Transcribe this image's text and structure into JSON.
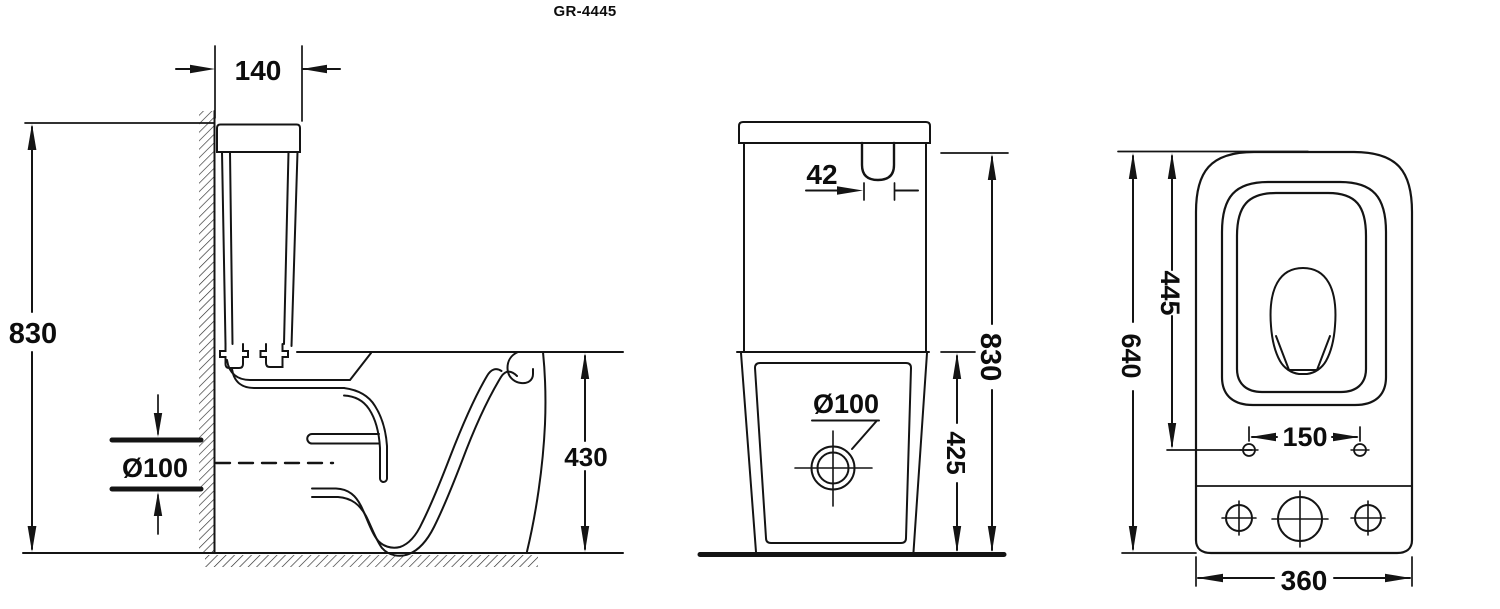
{
  "title": "GR-4445",
  "colors": {
    "ink": "#121212",
    "background": "#ffffff"
  },
  "views": {
    "side": {
      "dim_tank_depth": "140",
      "dim_overall_height": "830",
      "dim_outlet_diameter": "Ø100",
      "dim_bowl_height": "430"
    },
    "front": {
      "dim_flush_button_width": "42",
      "dim_overall_height": "830",
      "dim_bowl_height": "425",
      "dim_outlet_diameter": "Ø100"
    },
    "top": {
      "dim_overall_depth": "640",
      "dim_seat_depth": "445",
      "dim_fixing_hole_spacing": "150",
      "dim_overall_width": "360"
    }
  }
}
